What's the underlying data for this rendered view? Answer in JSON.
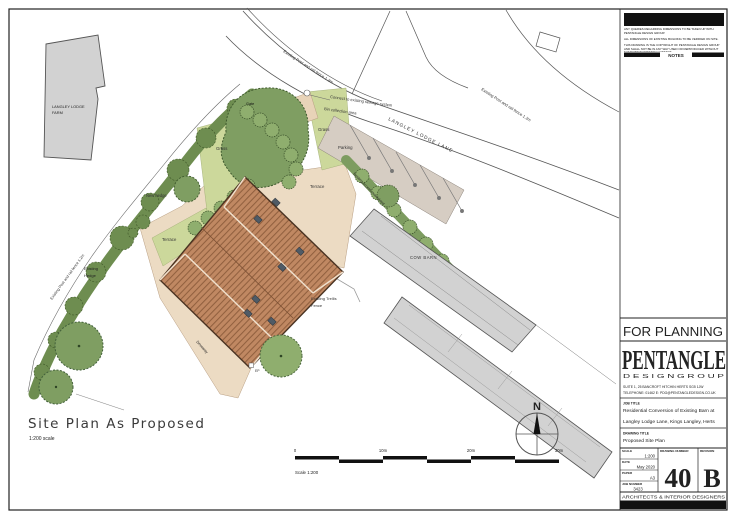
{
  "notes_panel": {
    "title": "NOTES",
    "note1": "ANY QUERIES REGARDING DIMENSIONS TO BE TAKEN UP WITH PENTANGLE DESIGN GROUP.",
    "note2": "ALL DIMENSIONS OF EXISTING BUILDING TO BE VERIFIED ON SITE.",
    "note3": "THIS DRAWING IS THE COPYRIGHT OF PENTANGLE DESIGN GROUP AND SHALL NOT BE IN ANY WAY USED OR REPRODUCED WITHOUT THEIR PRIOR WRITTEN CONSENT."
  },
  "title_block": {
    "status": "FOR PLANNING",
    "logo": "PENTANGLE",
    "logo_sub": "D E S I G N   G R O U P",
    "address": "SUITE 1,  25 BANCROFT   HITCHIN   HERTS   SG5 1JW",
    "contact": "TELEPHONE: 01462          E: PDG@PENTANGLEDESIGN.CO.UK",
    "job_title_label": "JOB TITLE",
    "job_title_line1": "Residential Conversion of Existing Barn at",
    "job_title_line2": "Langley Lodge Lane, Kings Langley, Herts",
    "drawing_title_label": "DRAWING TITLE",
    "drawing_title": "Proposed Site Plan",
    "scale_label": "SCALE",
    "scale": "1:200",
    "date_label": "DATE",
    "date": "May 2020",
    "paper_label": "PAPER",
    "paper": "A3",
    "job_number_label": "JOB NUMBER",
    "job_number": "3423",
    "drawing_number_label": "DRAWING NUMBER",
    "drawing_number": "40",
    "revision_label": "REVISION",
    "revision": "B",
    "footer": "ARCHITECTS  &  INTERIOR  DESIGNERS"
  },
  "plan": {
    "title": "Site Plan As Proposed",
    "title_scale": "1:200 scale",
    "labels": {
      "farm_line1": "LANGLEY LODGE",
      "farm_line2": "FARM",
      "lane": "LANGLEY LODGE LANE",
      "fence_top": "Existing Post and rail fence 1.2m",
      "fence_right": "Existing Post and rail fence 1.2m",
      "fence_left": "Existing Post and rail fence 1.2m",
      "sewage": "Connect to existing sewage system",
      "bin": "Bin collection area",
      "gate": "Gate",
      "grass1": "Grass",
      "grass2": "Grass",
      "parking": "Parking",
      "terrace_north": "Terrace",
      "terrace_west": "Terrace",
      "new_hedge": "New hedge",
      "existing_hedge_line1": "Existing",
      "existing_hedge_line2": "Hedge",
      "access": "Existing access maintained",
      "cow_barn": "COW BARN",
      "trellis_line1": "Existing Trellis",
      "trellis_line2": "Fence",
      "driveway": "Driveway",
      "ep": "EP",
      "north": "N"
    },
    "scale_bar": {
      "t0": "0",
      "t10": "10m",
      "t20": "20m",
      "t30": "30m",
      "caption": "Scale 1:200"
    }
  },
  "colors": {
    "roof": "#c08862",
    "roof_line": "#91603f",
    "hedge": "#6e8d50",
    "canopy": "#7f9e62",
    "tree_light": "#8fae6e",
    "grass": "#ccd89b",
    "yard": "#ecdbc3",
    "parking": "#d6cdc3",
    "building_gray": "#d2d2d2",
    "skylight": "#4f5b66",
    "ink": "#111111"
  }
}
